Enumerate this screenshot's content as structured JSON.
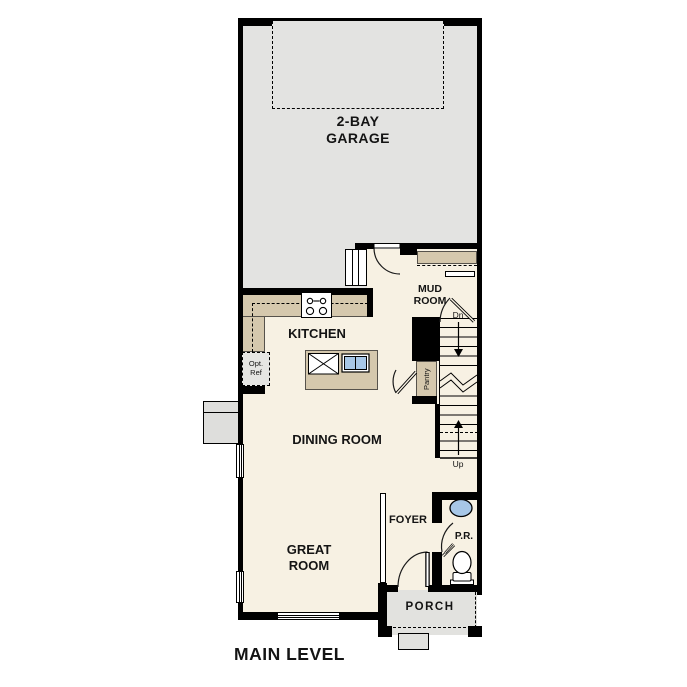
{
  "plan_title": "MAIN LEVEL",
  "colors": {
    "wall": "#000000",
    "floor": "#f7f1e3",
    "garage_floor": "#e3e3e1",
    "counter_tan": "#d5c8ad",
    "porch_gray": "#e2e2df",
    "sink_blue": "#a7c7e7",
    "text": "#141414"
  },
  "rooms": {
    "garage": {
      "line1": "2-BAY",
      "line2": "GARAGE"
    },
    "mud_room": {
      "line1": "MUD",
      "line2": "ROOM"
    },
    "kitchen": {
      "label": "KITCHEN"
    },
    "dining_room": {
      "label": "DINING ROOM"
    },
    "great_room": {
      "line1": "GREAT",
      "line2": "ROOM"
    },
    "foyer": {
      "label": "FOYER"
    },
    "powder_room": {
      "label": "P.R."
    },
    "porch": {
      "label": "PORCH"
    },
    "pantry": {
      "label": "Pantry"
    }
  },
  "stairs": {
    "down_label": "Dn",
    "up_label": "Up"
  },
  "appliances": {
    "dishwasher_label": "DW",
    "opt_ref_line1": "Opt.",
    "opt_ref_line2": "Ref"
  }
}
